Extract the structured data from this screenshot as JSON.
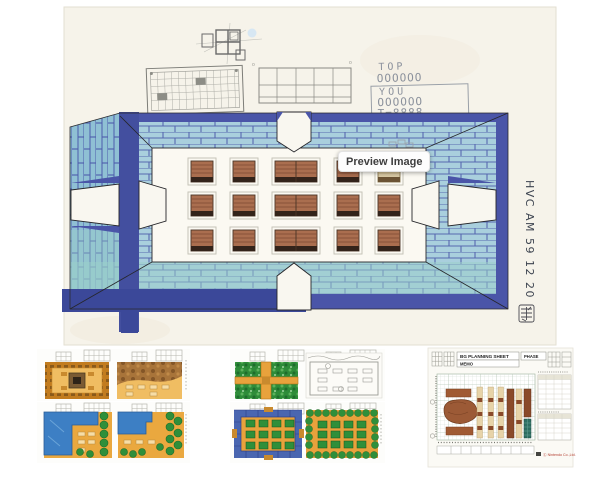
{
  "tooltip": {
    "label": "Preview Image"
  },
  "sheet": {
    "score": {
      "top_label": "TOP",
      "top_value": "OOOOOO",
      "you_label": "YOU",
      "you_value": "OOOOOO",
      "total": "T=8888"
    },
    "annotation": "HVC AM   59 12 20",
    "colors": {
      "paper": "#f6f3ea",
      "floor": "#fbf9f2",
      "wall_navy": "#4a55a8",
      "marker_navy": "#3b4899",
      "wall_teal": "#a9cfdd",
      "wall_teal_outer": "#8fc0d4",
      "wall_green_tint": "#9ccfc9",
      "brick_line": "#4d5cab",
      "block_brown": "#aa6e4f",
      "block_brown_dark": "#33231a",
      "block_tan": "#d9c9a4",
      "pencil": "#9aa0a8"
    }
  },
  "room": {
    "blocks": {
      "rows_y": [
        161,
        195,
        230
      ],
      "height": 21,
      "columns": [
        {
          "x": 191,
          "w": 22
        },
        {
          "x": 233,
          "w": 22
        },
        {
          "x": 275,
          "w": 42
        },
        {
          "x": 337,
          "w": 22
        },
        {
          "x": 378,
          "w": 22
        }
      ],
      "tan": {
        "row": 0,
        "col": 4
      }
    }
  },
  "thumbnails": {
    "left_sheet_colors": [
      "#eaa83f",
      "#c27c1f",
      "#a8743a",
      "#3d7fc4",
      "#2f8f3a"
    ],
    "middle_sheet_colors": [
      "#2e8c39",
      "#e8a23c",
      "#4a66b0",
      "#2f8f3a"
    ],
    "planning": {
      "title": "BG PLANNING SHEET",
      "memo_label": "MEMO",
      "phase_label": "PHASE",
      "copyright": "Ⓒ Nintendo Co.,Ltd."
    }
  }
}
